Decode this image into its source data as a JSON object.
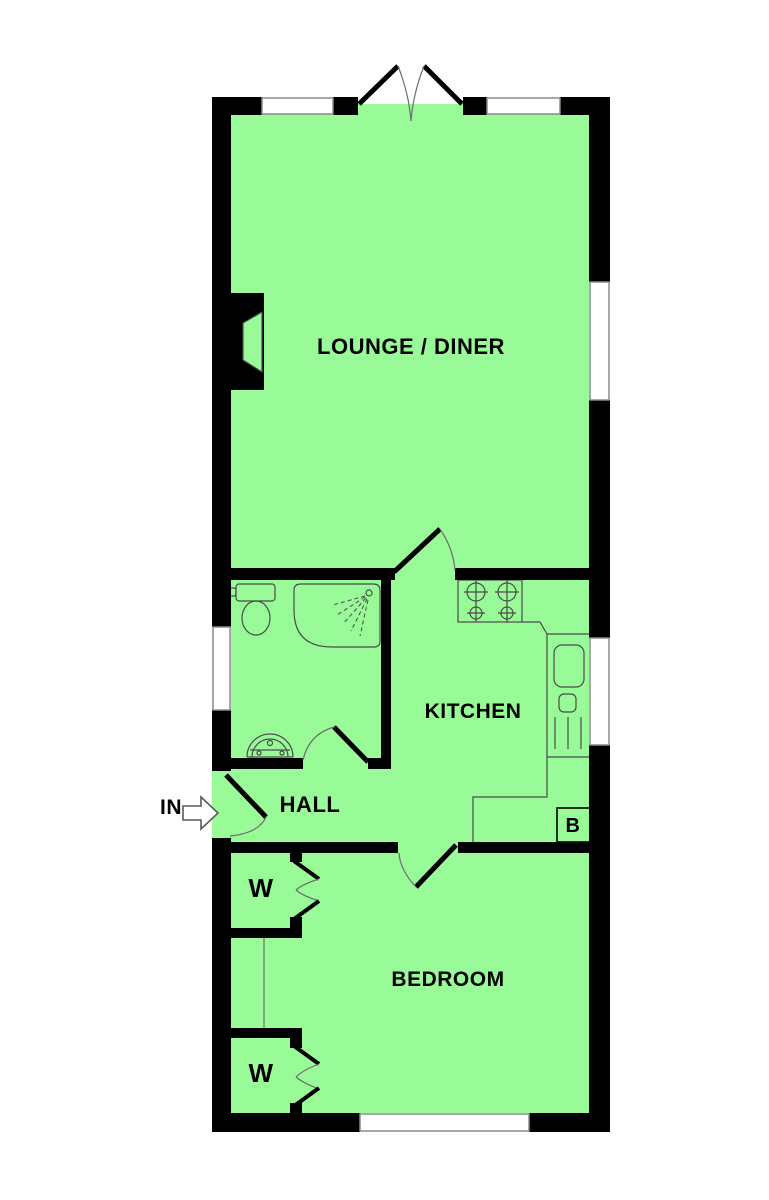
{
  "page": {
    "background": "#FFFFFF"
  },
  "colors": {
    "page_bg": "#FFFFFF",
    "floor": "#98FB98",
    "wall": "#000000",
    "window_fill": "#FFFFFF",
    "window_outline": "#8A8A8A",
    "fixture_line": "#4A4A4A",
    "arc_line": "#6E6E6E",
    "text": "#000000",
    "arrow_fill": "#FFFFFF",
    "arrow_outline": "#5A5A5A"
  },
  "labels": {
    "lounge": "LOUNGE / DINER",
    "kitchen": "KITCHEN",
    "hall": "HALL",
    "bedroom": "BEDROOM",
    "wardrobe_top": "W",
    "wardrobe_bottom": "W",
    "boiler": "B",
    "entrance": "IN"
  },
  "icons": [
    "entry-arrow-icon",
    "french-doors-icon",
    "door-swing-arc-icon",
    "fireplace-recess-icon",
    "toilet-icon",
    "shower-icon",
    "washbasin-icon",
    "hob-icon",
    "sink-drainer-icon",
    "boiler-box-icon",
    "bifold-wardrobe-doors-icon",
    "window-icon"
  ]
}
